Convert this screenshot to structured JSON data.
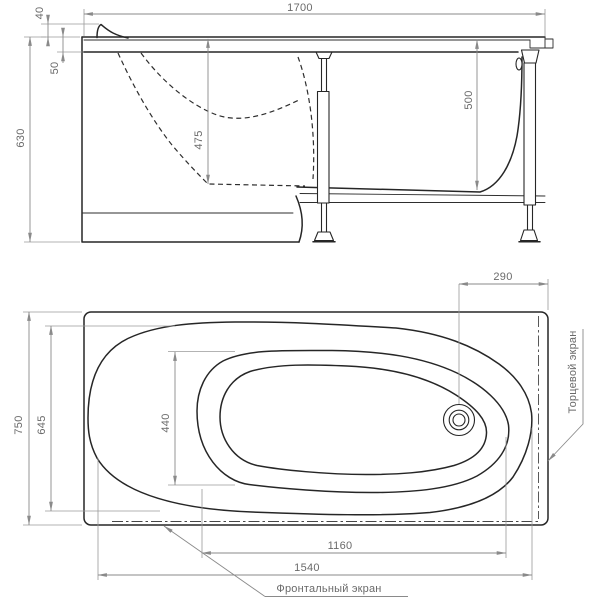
{
  "drawing": {
    "side_view": {
      "dims": {
        "length": "1700",
        "headrest_height": "40",
        "apron_drop": "50",
        "overall_height": "630",
        "depth_head": "475",
        "depth_foot": "500"
      }
    },
    "plan_view": {
      "dims": {
        "overall_width": "750",
        "bowl_outer_width": "645",
        "bowl_inner_width": "440",
        "drain_offset": "290",
        "bowl_length": "1160",
        "apron_length": "1540"
      },
      "labels": {
        "front_panel": "Фронтальный экран",
        "end_panel": "Торцевой экран"
      }
    }
  }
}
